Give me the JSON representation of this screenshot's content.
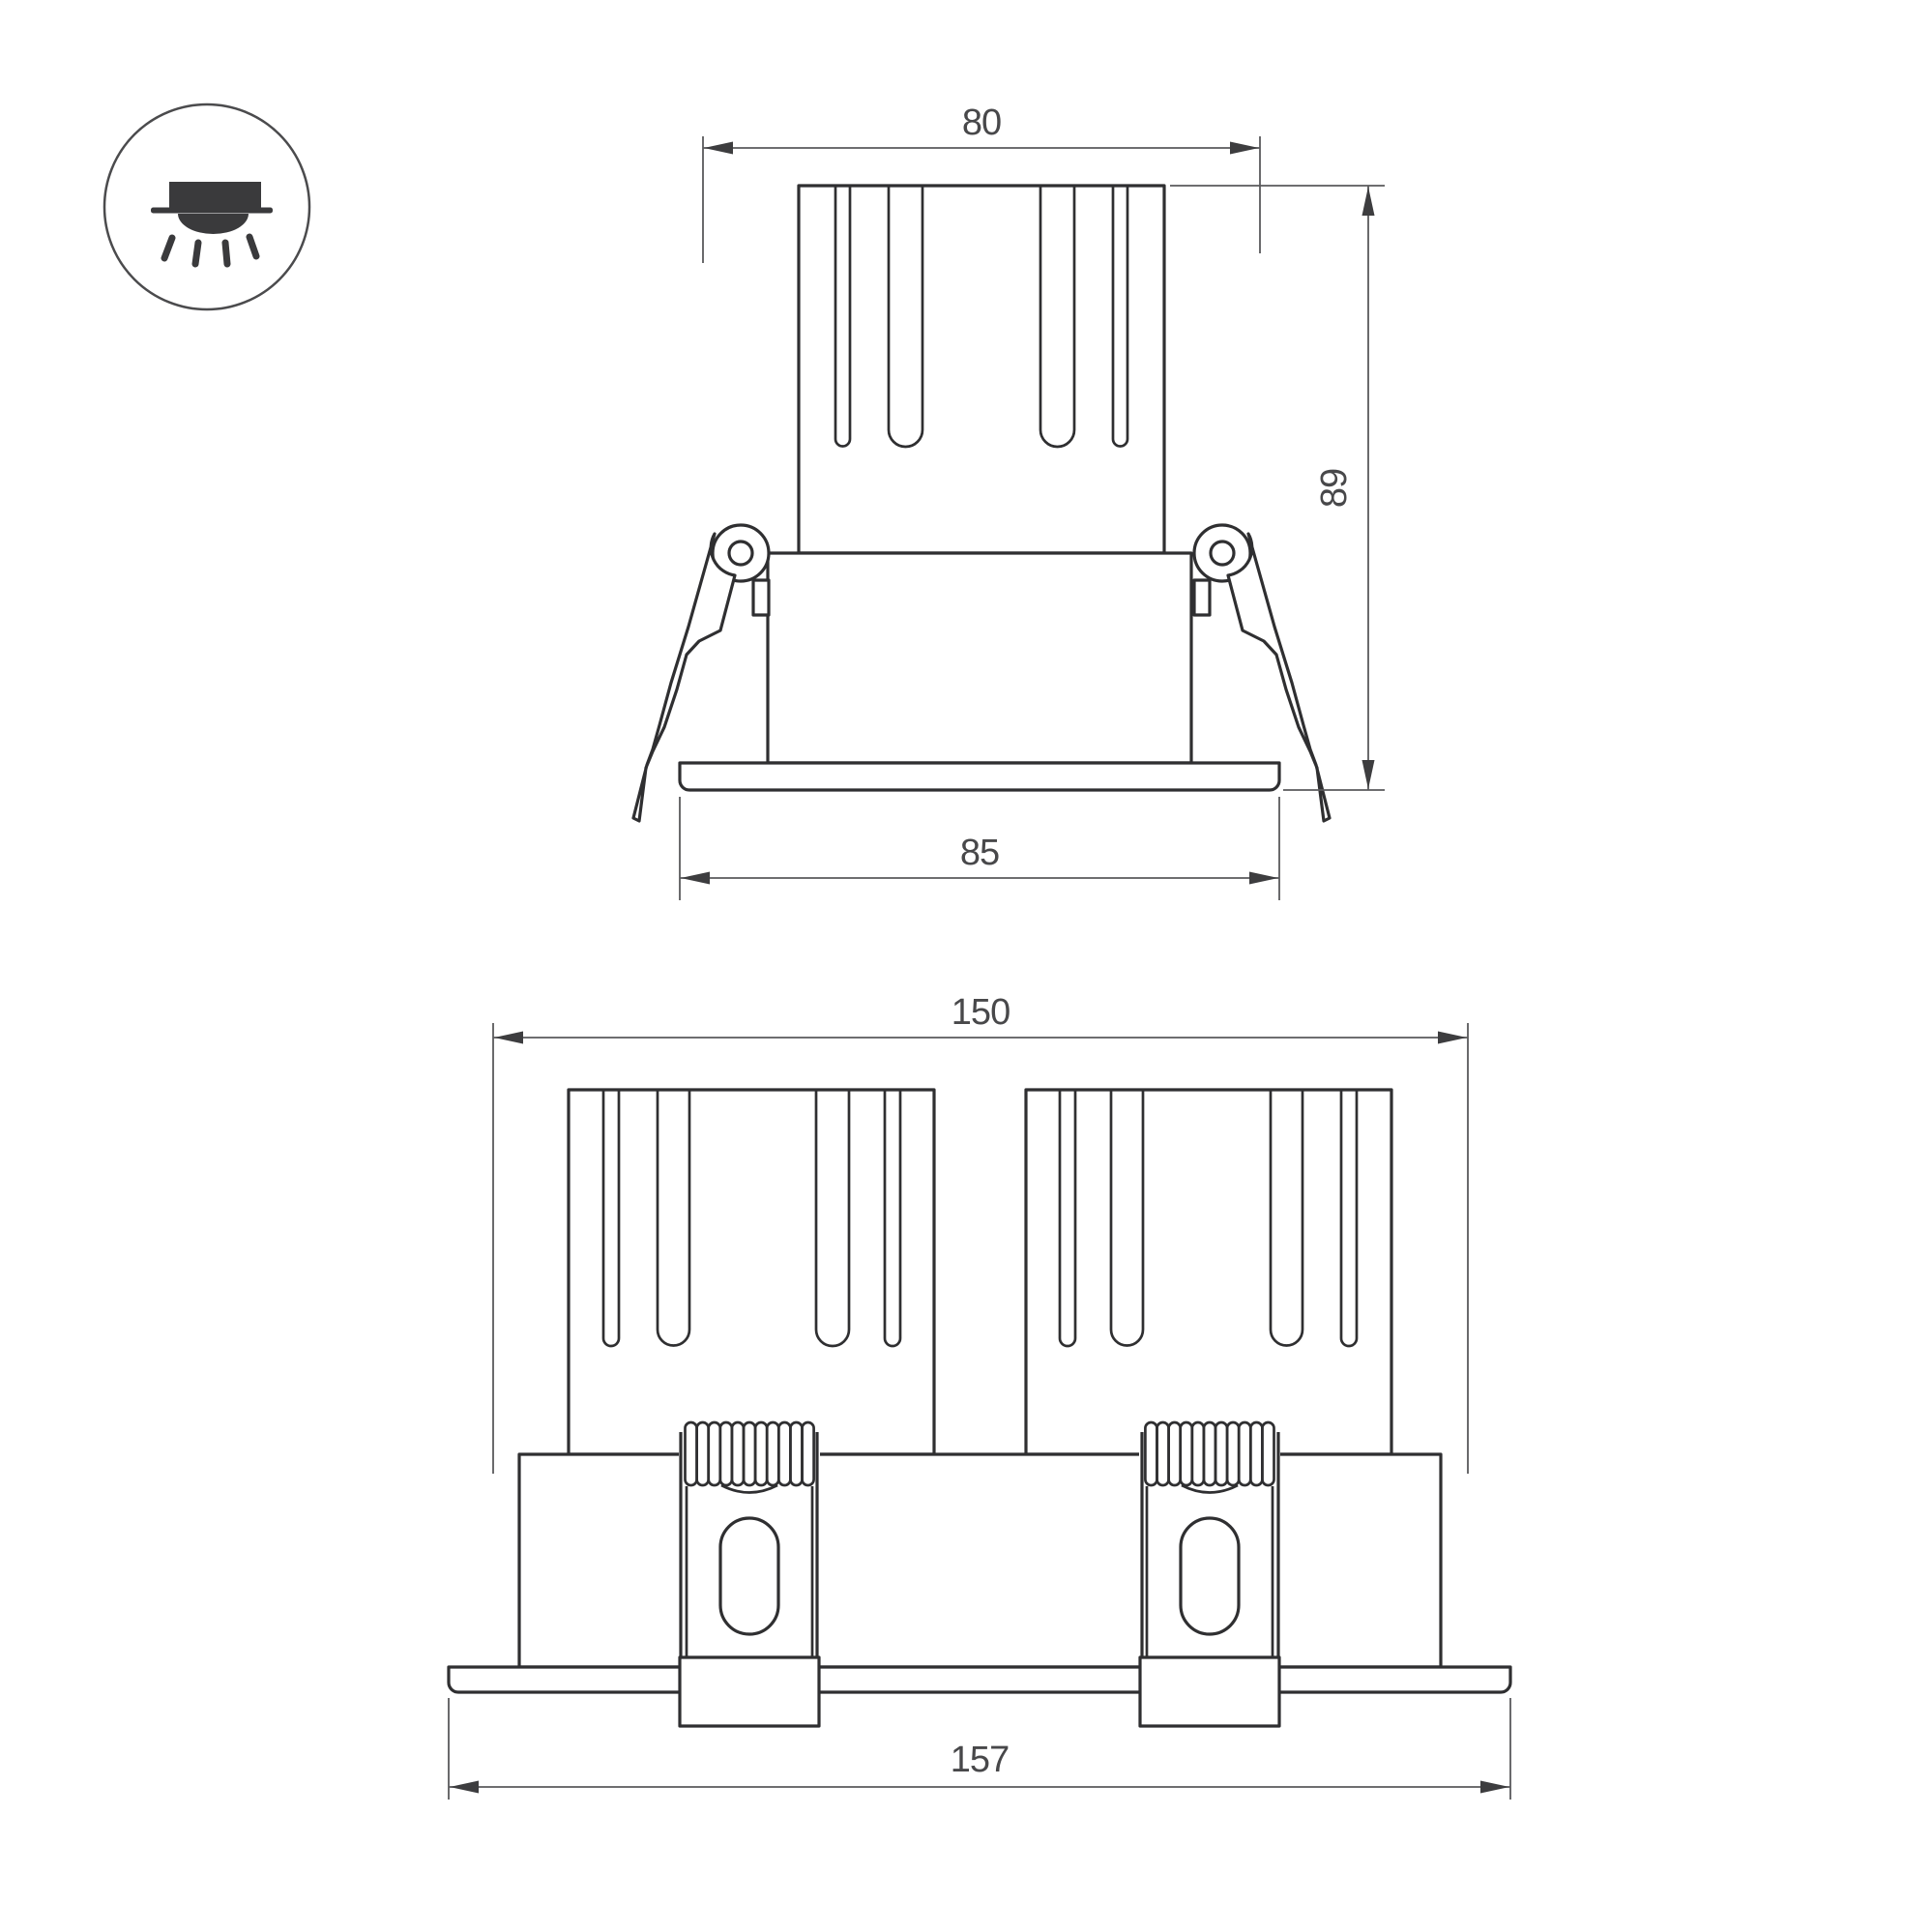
{
  "page": {
    "background": "#ffffff"
  },
  "colors": {
    "outline": "#2f2f31",
    "dimension_line": "#5a5a5c",
    "dimension_text": "#48484a",
    "icon": "#3a3a3c"
  },
  "icon": {
    "name": "recessed-downlight-icon"
  },
  "views": {
    "front": {
      "name": "front-view-single-module",
      "dimensions": {
        "top_width": {
          "value": "80"
        },
        "height": {
          "value": "89"
        },
        "flange_width": {
          "value": "85"
        }
      }
    },
    "side": {
      "name": "side-view-double-module",
      "dimensions": {
        "overall_width": {
          "value": "150"
        },
        "flange_width": {
          "value": "157"
        }
      }
    }
  }
}
